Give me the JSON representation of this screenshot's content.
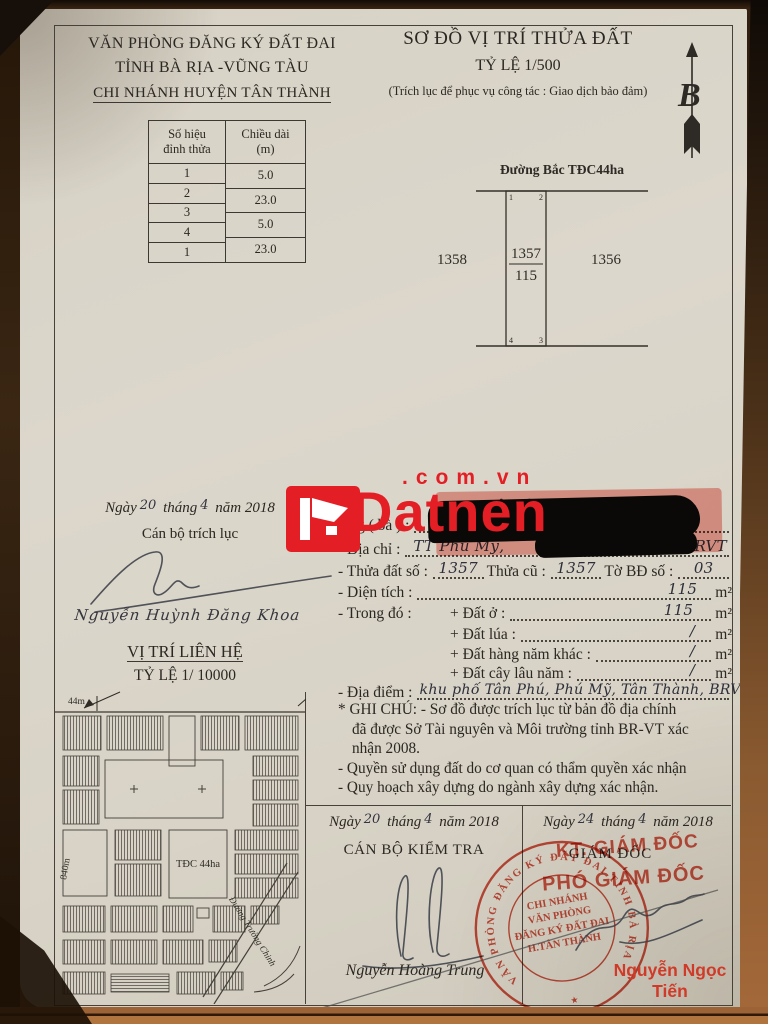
{
  "colors": {
    "stamp_red": "#cf3b28",
    "brand_red": "#e41e25",
    "paper": "#d9d4c9",
    "ink": "#2b2722"
  },
  "header": {
    "office_lines": [
      "VĂN PHÒNG ĐĂNG KÝ ĐẤT ĐAI",
      "TỈNH BÀ RỊA -VŨNG TÀU",
      "CHI NHÁNH HUYỆN TÂN THÀNH"
    ],
    "title": "SƠ ĐỒ VỊ TRÍ THỬA ĐẤT",
    "scale": "TỶ LỆ 1/500",
    "purpose": "(Trích lục để phục vụ công tác : Giao dịch bảo đảm)",
    "north_glyph": "B"
  },
  "vertex_table": {
    "col1_header_line1": "Số hiệu",
    "col1_header_line2": "đỉnh thửa",
    "col2_header_line1": "Chiều dài",
    "col2_header_line2": "(m)",
    "vertices": [
      "1",
      "2",
      "3",
      "4",
      "1"
    ],
    "lengths": [
      "5.0",
      "23.0",
      "5.0",
      "23.0"
    ]
  },
  "plot": {
    "road_label": "Đường Bắc TĐC44ha",
    "corner_1": "1",
    "corner_2": "2",
    "corner_3": "3",
    "corner_4": "4",
    "parcel_number": "1357",
    "parcel_area": "115",
    "left_neighbor": "1358",
    "right_neighbor": "1356"
  },
  "watermark": {
    "brand": "Datnen",
    "suffix": ".com.vn"
  },
  "extract": {
    "ngay": "Ngày",
    "day": "20",
    "thang": "tháng",
    "month": "4",
    "nam": "năm",
    "year": "2018",
    "role": "Cán bộ trích lục",
    "name": "Nguyễn Huỳnh Đăng Khoa"
  },
  "info": {
    "intro_fragment": "nêu trên của :",
    "owner_label": "Ông ( bà ) :",
    "address_label": "- Địa chỉ :",
    "address_start": "TT Phú Mỹ,",
    "address_end": "BRVT",
    "parcel_label": "- Thửa đất số :",
    "parcel_value": "1357",
    "old_label": "Thửa cũ :",
    "old_value": "1357",
    "sheet_label": "Tờ BĐ số :",
    "sheet_value": "03",
    "area_label": "- Diện tích  :",
    "area_value": "115",
    "unit": "m²",
    "detail_label": "- Trong đó :",
    "land_items": [
      {
        "label": "+ Đất ở :",
        "value": "115"
      },
      {
        "label": "+ Đất lúa :",
        "value": "/"
      },
      {
        "label": "+ Đất hàng năm khác :",
        "value": "/"
      },
      {
        "label": "+ Đất cây lâu năm :",
        "value": "/"
      }
    ],
    "place_label": "- Địa điểm :",
    "place_value": "khu phố Tân Phú, Phú Mỹ, Tân Thành, BRVT",
    "notes": [
      "* GHI CHÚ:  - Sơ đồ được trích lục từ bản đồ địa chính",
      "đã được Sở Tài nguyên và Môi trường tỉnh BR-VT xác",
      "nhận 2008.",
      "- Quyền sử dụng đất do cơ quan có thẩm quyền xác nhận",
      "- Quy hoạch xây dựng do ngành xây dựng xác nhận."
    ]
  },
  "location_map": {
    "title": "VỊ TRÍ LIÊN HỆ",
    "scale": "TỶ LỆ 1/ 10000",
    "top_dim": "44m",
    "left_dim": "840m",
    "area_label": "TĐC 44ha",
    "road_label": "Đường Trường Chinh"
  },
  "approval": {
    "left": {
      "ngay": "Ngày",
      "day": "20",
      "thang": "tháng",
      "month": "4",
      "nam": "năm",
      "year": "2018",
      "role": "CÁN BỘ KIỂM TRA",
      "name": "Nguyễn Hoàng Trung"
    },
    "right": {
      "ngay": "Ngày",
      "day": "24",
      "thang": "tháng",
      "month": "4",
      "nam": "năm",
      "year": "2018",
      "role": "GIÁM ĐỐC",
      "stamp_role_1": "KT. GIÁM ĐỐC",
      "stamp_role_2": "PHÓ GIÁM ĐỐC",
      "name": "Nguyễn Ngọc Tiến"
    }
  },
  "stamp": {
    "ring_text": "VĂN PHÒNG ĐĂNG KÝ ĐẤT ĐAI TỈNH BÀ RỊA VŨNG TÀU",
    "center_lines": [
      "CHI NHÁNH",
      "VĂN PHÒNG",
      "ĐĂNG KÝ ĐẤT ĐAI",
      "H.TÂN THÀNH"
    ],
    "star": "★"
  }
}
